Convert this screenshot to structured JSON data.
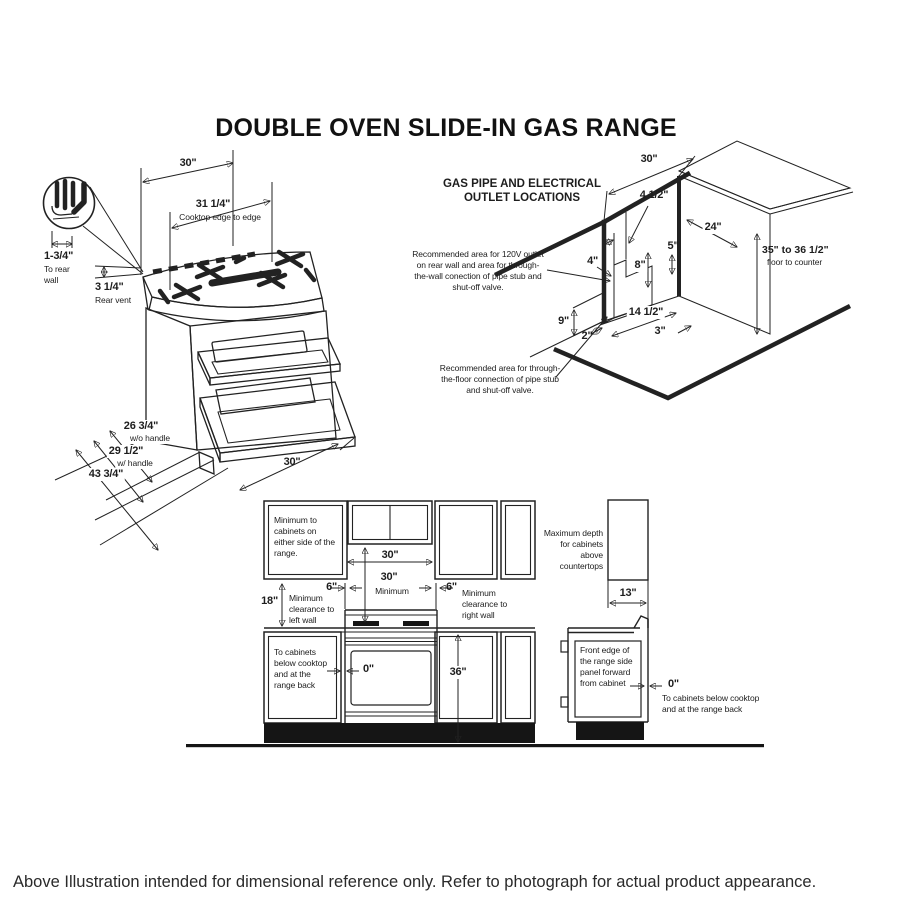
{
  "page": {
    "title": "DOUBLE OVEN SLIDE-IN GAS RANGE",
    "footer": "Above Illustration intended for dimensional reference only. Refer to photograph for actual product appearance."
  },
  "range_view": {
    "width_top": "30\"",
    "cooktop_width": "31 1/4\"",
    "cooktop_width_note": "Cooktop edge to edge",
    "rear_gap": "1-3/4\"",
    "rear_gap_note": "To rear wall",
    "rear_vent": "3 1/4\"",
    "rear_vent_note": "Rear vent",
    "depth_wo_handle": "26 3/4\"",
    "depth_wo_handle_note": "w/o handle",
    "depth_w_handle": "29 1/2\"",
    "depth_w_handle_note": "w/ handle",
    "depth_door_open": "43 3/4\"",
    "width_bottom": "30\""
  },
  "gas_view": {
    "heading": "GAS PIPE AND ELECTRICAL OUTLET LOCATIONS",
    "wall_note": "Recommended area for 120V outlet on rear wall and area for through-the-wall conection of pipe stub and shut-off valve.",
    "floor_note": "Recommended area for through-the-floor connection of pipe stub and shut-off valve.",
    "wall_width": "30\"",
    "area_width": "4 1/2\"",
    "area_offset": "4\"",
    "dim_5": "5\"",
    "area_height": "8\"",
    "dim_9": "9\"",
    "floor_offset": "2\"",
    "floor_width": "14 1/2\"",
    "dim_3": "3\"",
    "counter_depth": "24\"",
    "counter_height": "35\" to 36 1/2\"",
    "counter_height_note": "floor to counter"
  },
  "clearance_view": {
    "side_note": "Minimum to cabinets on either side of the range.",
    "top_width": "30\"",
    "min_height": "30\"",
    "min_height_note": "Minimum",
    "left_clearance": "6\"",
    "left_wall_note": "Minimum clearance to left wall",
    "right_clearance": "6\"",
    "right_wall_note": "Minimum clearance to right wall",
    "left_wall_gap": "18\"",
    "below_note": "To cabinets below cooktop and at the range back",
    "zero_left": "0\"",
    "counter_height": "36\"",
    "depth_note": "Maximum depth for cabinets above countertops",
    "cabinet_depth": "13\"",
    "front_edge_note": "Front edge of the range side panel forward from cabinet",
    "zero_right": "0\"",
    "below_note_right": "To cabinets below cooktop and at the range back"
  }
}
